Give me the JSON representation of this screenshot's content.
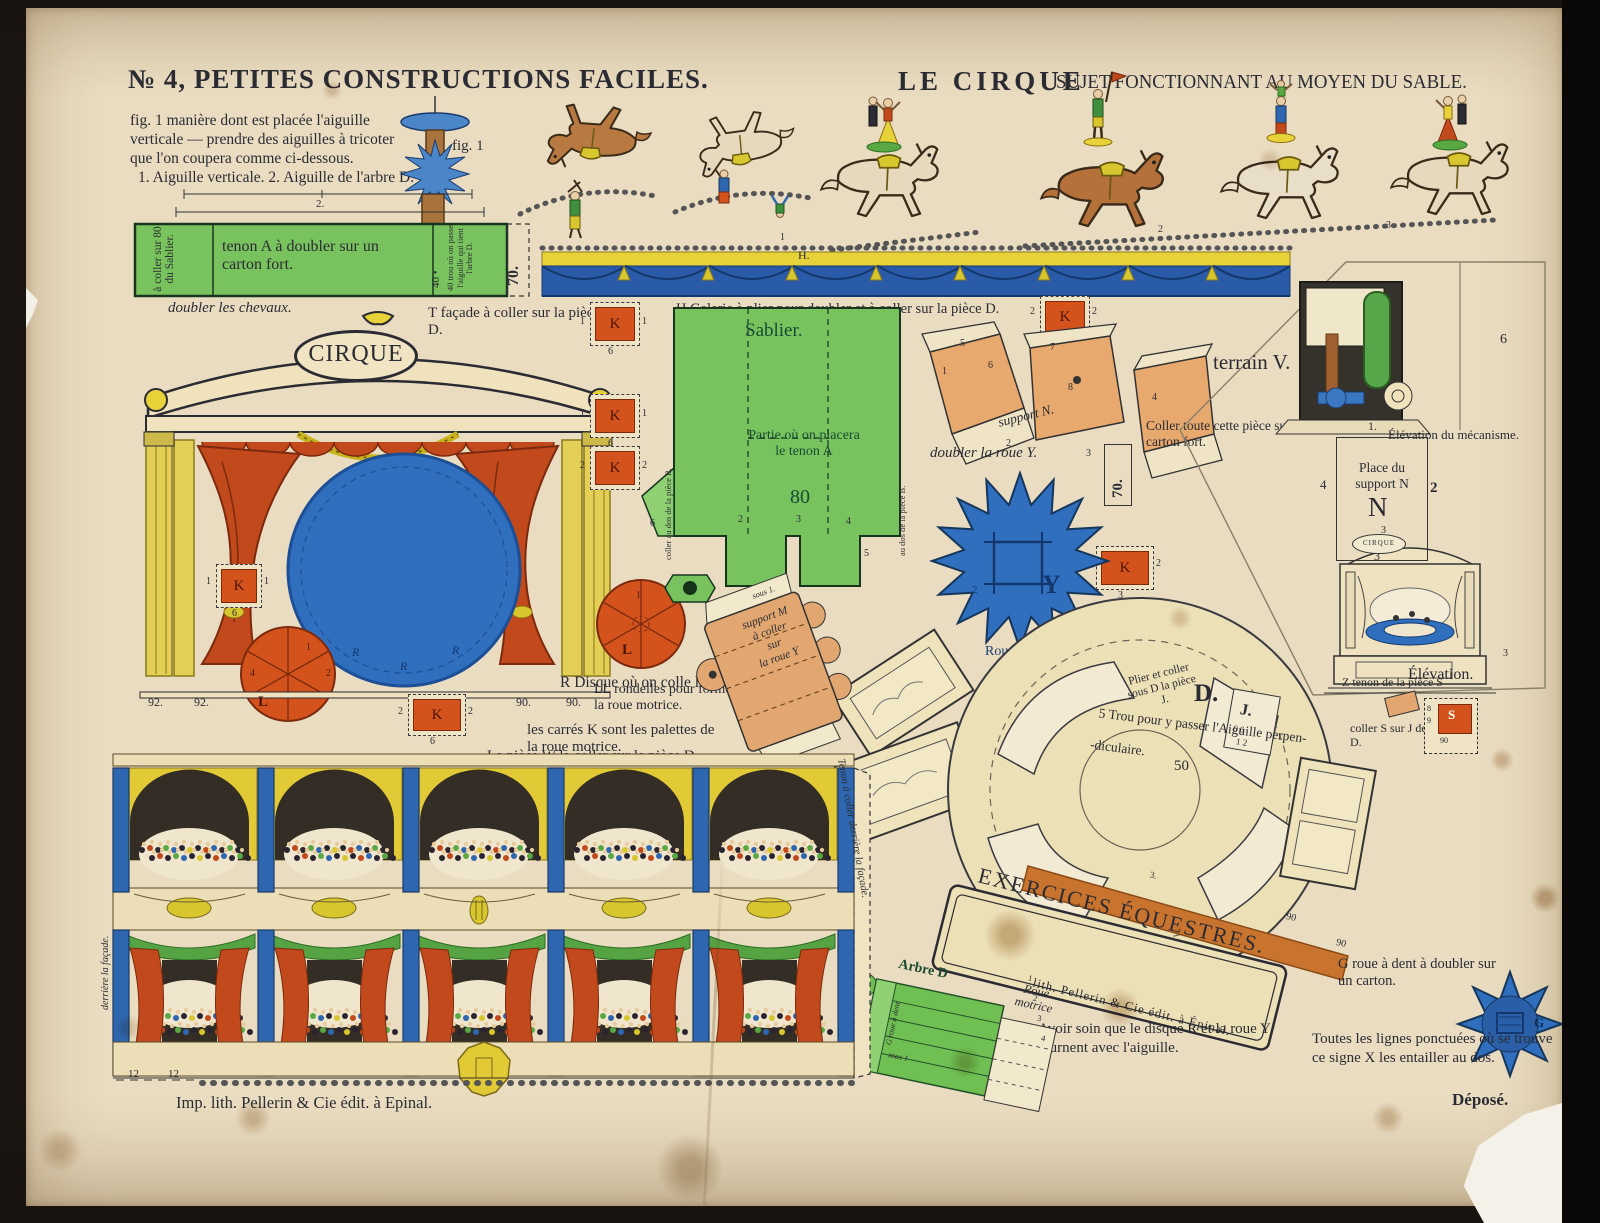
{
  "header": {
    "series": "№ 4, PETITES CONSTRUCTIONS FACILES.",
    "title": "LE CIRQUE",
    "subtitle": "SUJET FONCTIONNANT AU MOYEN DU SABLE."
  },
  "fig1": {
    "lines": [
      "fig. 1 manière dont est placée l'aiguille",
      "verticale — prendre des aiguilles à tricoter",
      "que l'on coupera comme ci-dessous.",
      "1. Aiguille verticale. 2. Aiguille de l'arbre D."
    ],
    "label": "fig. 1",
    "ruler2": "2."
  },
  "strip": {
    "left": "à coller sur 80 du Sablier.",
    "main": "tenon A à doubler sur un carton fort.",
    "hole": "40 •",
    "right": "40 trou où on passe l'aiguille qui tient l'arbre D.",
    "num": "70."
  },
  "cap": {
    "doubler_chevaux": "doubler les chevaux.",
    "doubler_roue_y": "doubler la roue Y.",
    "coller_carton": "Coller toute cette pièce sur un carton fort.",
    "num70": "70.",
    "r_disque": "R Disque où on colle les Chevaux.",
    "carres_k": "les carrés K sont les palettes de la roue motrice.",
    "ll_rondelles": "LL rondelles pour former la roue motrice.",
    "piece_w": "La pièce W la coller sur la pièce D.",
    "g_roue": "G roue à dent à doubler sur un carton.",
    "lignes": "Toutes les lignes ponctuées où se trouve ce signe X les entailler au dos.",
    "avoir": "Avoir soin que le disque R et la roue Y tournent avec l'aiguille.",
    "depose": "Déposé."
  },
  "gallery": {
    "letter": "H.",
    "caption": "H Galerie à plier pour doubler et à coller sur la pièce D."
  },
  "facade": {
    "sign": "CIRQUE",
    "caption": "T façade à coller sur la pièce D.",
    "disc_letter": "R",
    "wheel_letter": "L",
    "nums": [
      "92.",
      "92.",
      "90.",
      "90."
    ],
    "wheel1_nums": [
      "1",
      "2",
      "4"
    ],
    "wheel2_num": "1"
  },
  "horses": {
    "nums": [
      "1",
      "2",
      "3"
    ]
  },
  "sablier": {
    "title": "Sablier.",
    "partie": "Partie où on placera le tenon A",
    "num80": "80",
    "edge_left": "coller au dos de la pièce B.",
    "edge_right": "au dos de la pièce B.",
    "tabs": [
      "6",
      "2",
      "3",
      "4",
      "5"
    ]
  },
  "k": {
    "letter": "K",
    "one": "1",
    "two": "2",
    "three": "3",
    "six": "6"
  },
  "supportn": {
    "label": "support N.",
    "nums": [
      "5",
      "6",
      "7",
      "8",
      "1",
      "2",
      "3",
      "4"
    ]
  },
  "terrain": {
    "label": "terrain V.",
    "elev_meca": "Élévation du mécanisme.",
    "place_title": "Place du support N",
    "n": "N",
    "nums": {
      "one": "1.",
      "four": "4",
      "two": "2",
      "three": "3",
      "six": "6"
    },
    "elevation": "Élévation.",
    "mini_sign": "CIRQUE",
    "mini_nums": [
      "3",
      "3"
    ]
  },
  "rouey": {
    "label": "Roue Y",
    "letter": "Y",
    "num2": "2"
  },
  "supportm": {
    "lines": [
      "support M",
      "à coller",
      "sur",
      "la roue Y"
    ],
    "sous": "sous 1."
  },
  "discd": {
    "plier": [
      "Plier et coller",
      "sous D la pièce",
      "J."
    ],
    "d": "D.",
    "j": "J.",
    "jrow1": "6  6",
    "jrow2": "1  2",
    "trou1": "5 Trou pour y passer l'Aiguille perpen-",
    "trou2": "-diculaire.",
    "n50": "50",
    "n3": "3.",
    "n90a": "90",
    "n90b": "90"
  },
  "banner": {
    "text": "EXERCICES ÉQUESTRES.",
    "credit": "lith. Pellerin & Cie édit. à Épinal."
  },
  "zs": {
    "z_text": "Z tenon de la pièce S",
    "s_text": "coller S sur J de la pièce D.",
    "letter": "S",
    "n8": "8",
    "n9": "9",
    "n90": "90"
  },
  "gstar": {
    "letter": "G"
  },
  "arbre": {
    "title": "Arbre D",
    "roue1": "Roue",
    "roue2": "motrice",
    "side": "G roue à dent",
    "sous": "sous 1",
    "nums": [
      "1",
      "2",
      "3",
      "4"
    ]
  },
  "theatre": {
    "left_edge": "derrière la façade.",
    "right_edge": "Tenon à coller derrière la façade.",
    "n12a": "12",
    "n12b": "12"
  },
  "footer": {
    "imprint": "Imp. lith. Pellerin & Cie édit. à Epinal."
  },
  "colors": {
    "paper": "#e9dcc0",
    "ink": "#2b2b33",
    "green_piece": "#79c35e",
    "orange_piece": "#d4531d",
    "peach_piece": "#e8a96e",
    "blue": "#2f6fbe",
    "navy_drape": "#2a5ba8",
    "yellow": "#e2ca37",
    "curtain_red": "#c2491c"
  }
}
